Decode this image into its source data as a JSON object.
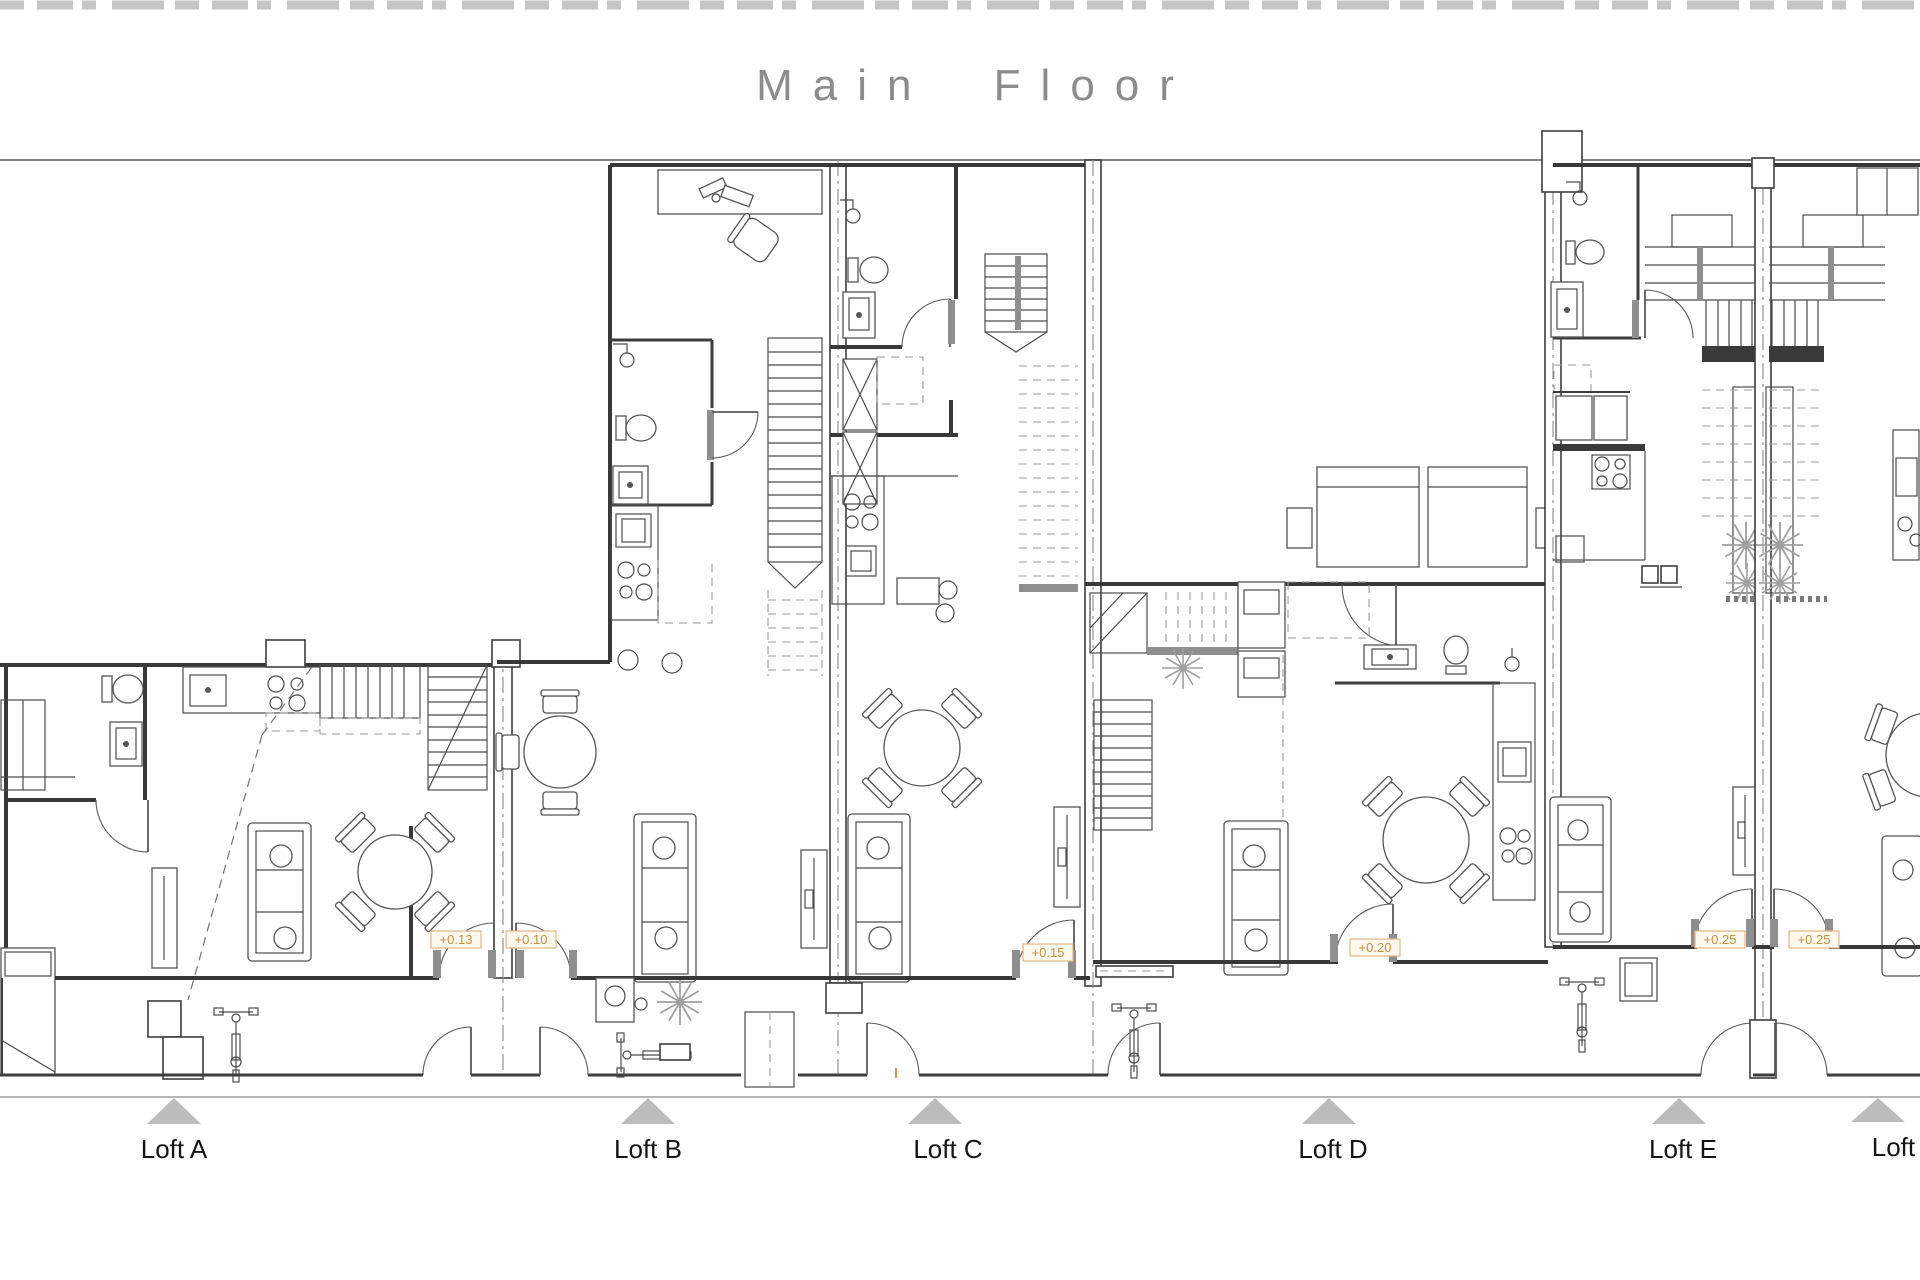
{
  "title": "Main Floor",
  "lofts": [
    {
      "label": "Loft A"
    },
    {
      "label": "Loft B"
    },
    {
      "label": "Loft C"
    },
    {
      "label": "Loft D"
    },
    {
      "label": "Loft E"
    },
    {
      "label": "Loft F"
    }
  ],
  "elevations": [
    {
      "value": "+0.13"
    },
    {
      "value": "+0.10"
    },
    {
      "value": "+0.15"
    },
    {
      "value": "+0.20"
    },
    {
      "value": "+0.25"
    },
    {
      "value": "+0.25"
    }
  ],
  "colors": {
    "line": "#3a3a3a",
    "title_gray": "#8c8c8c",
    "triangle_gray": "#bcbcbc",
    "elevation_accent": "#c9913c",
    "background": "#ffffff"
  },
  "icons": {
    "triangle": "loft-position-marker",
    "arc": "door-swing",
    "starburst": "plant"
  }
}
